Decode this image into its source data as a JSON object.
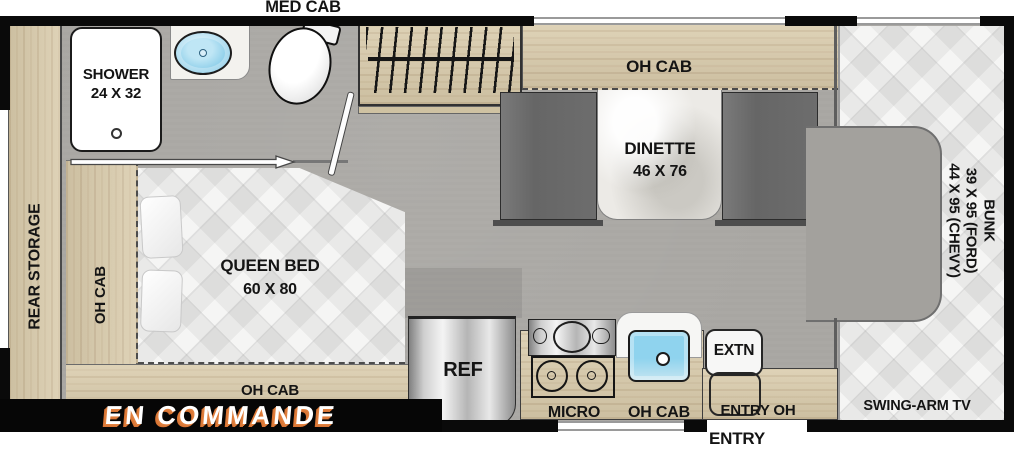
{
  "labels": {
    "med_cab": "MED CAB",
    "shower_name": "SHOWER",
    "shower_size": "24 X 32",
    "rear_storage": "REAR STORAGE",
    "oh_cab_bed_side": "OH CAB",
    "oh_cab_bed_foot": "OH CAB",
    "queen_bed_name": "QUEEN BED",
    "queen_bed_size": "60 X 80",
    "oh_cab_dinette": "OH CAB",
    "dinette_name": "DINETTE",
    "dinette_size": "46 X 76",
    "bunk_name": "BUNK",
    "bunk_size_ford": "39 X 95 (FORD)",
    "bunk_size_chevy": "44 X 95 (CHEVY)",
    "swing_arm_tv": "SWING-ARM TV",
    "ref": "REF",
    "micro": "MICRO",
    "oh_cab_kitchen": "OH CAB",
    "extn": "EXTN",
    "entry_oh": "ENTRY OH",
    "entry": "ENTRY",
    "banner": "EN COMMANDE"
  },
  "colors": {
    "wood": "#d9cbab",
    "floor": "#a8a6a2",
    "bench_gray": "#6e6e6e",
    "quilt_white": "#f5f5f4",
    "sink_blue": "#8fd3ee",
    "wall_black": "#0a0a0a",
    "banner_bg": "#060606",
    "banner_text": "#ffffff",
    "banner_shadow": "#dd7a38"
  }
}
